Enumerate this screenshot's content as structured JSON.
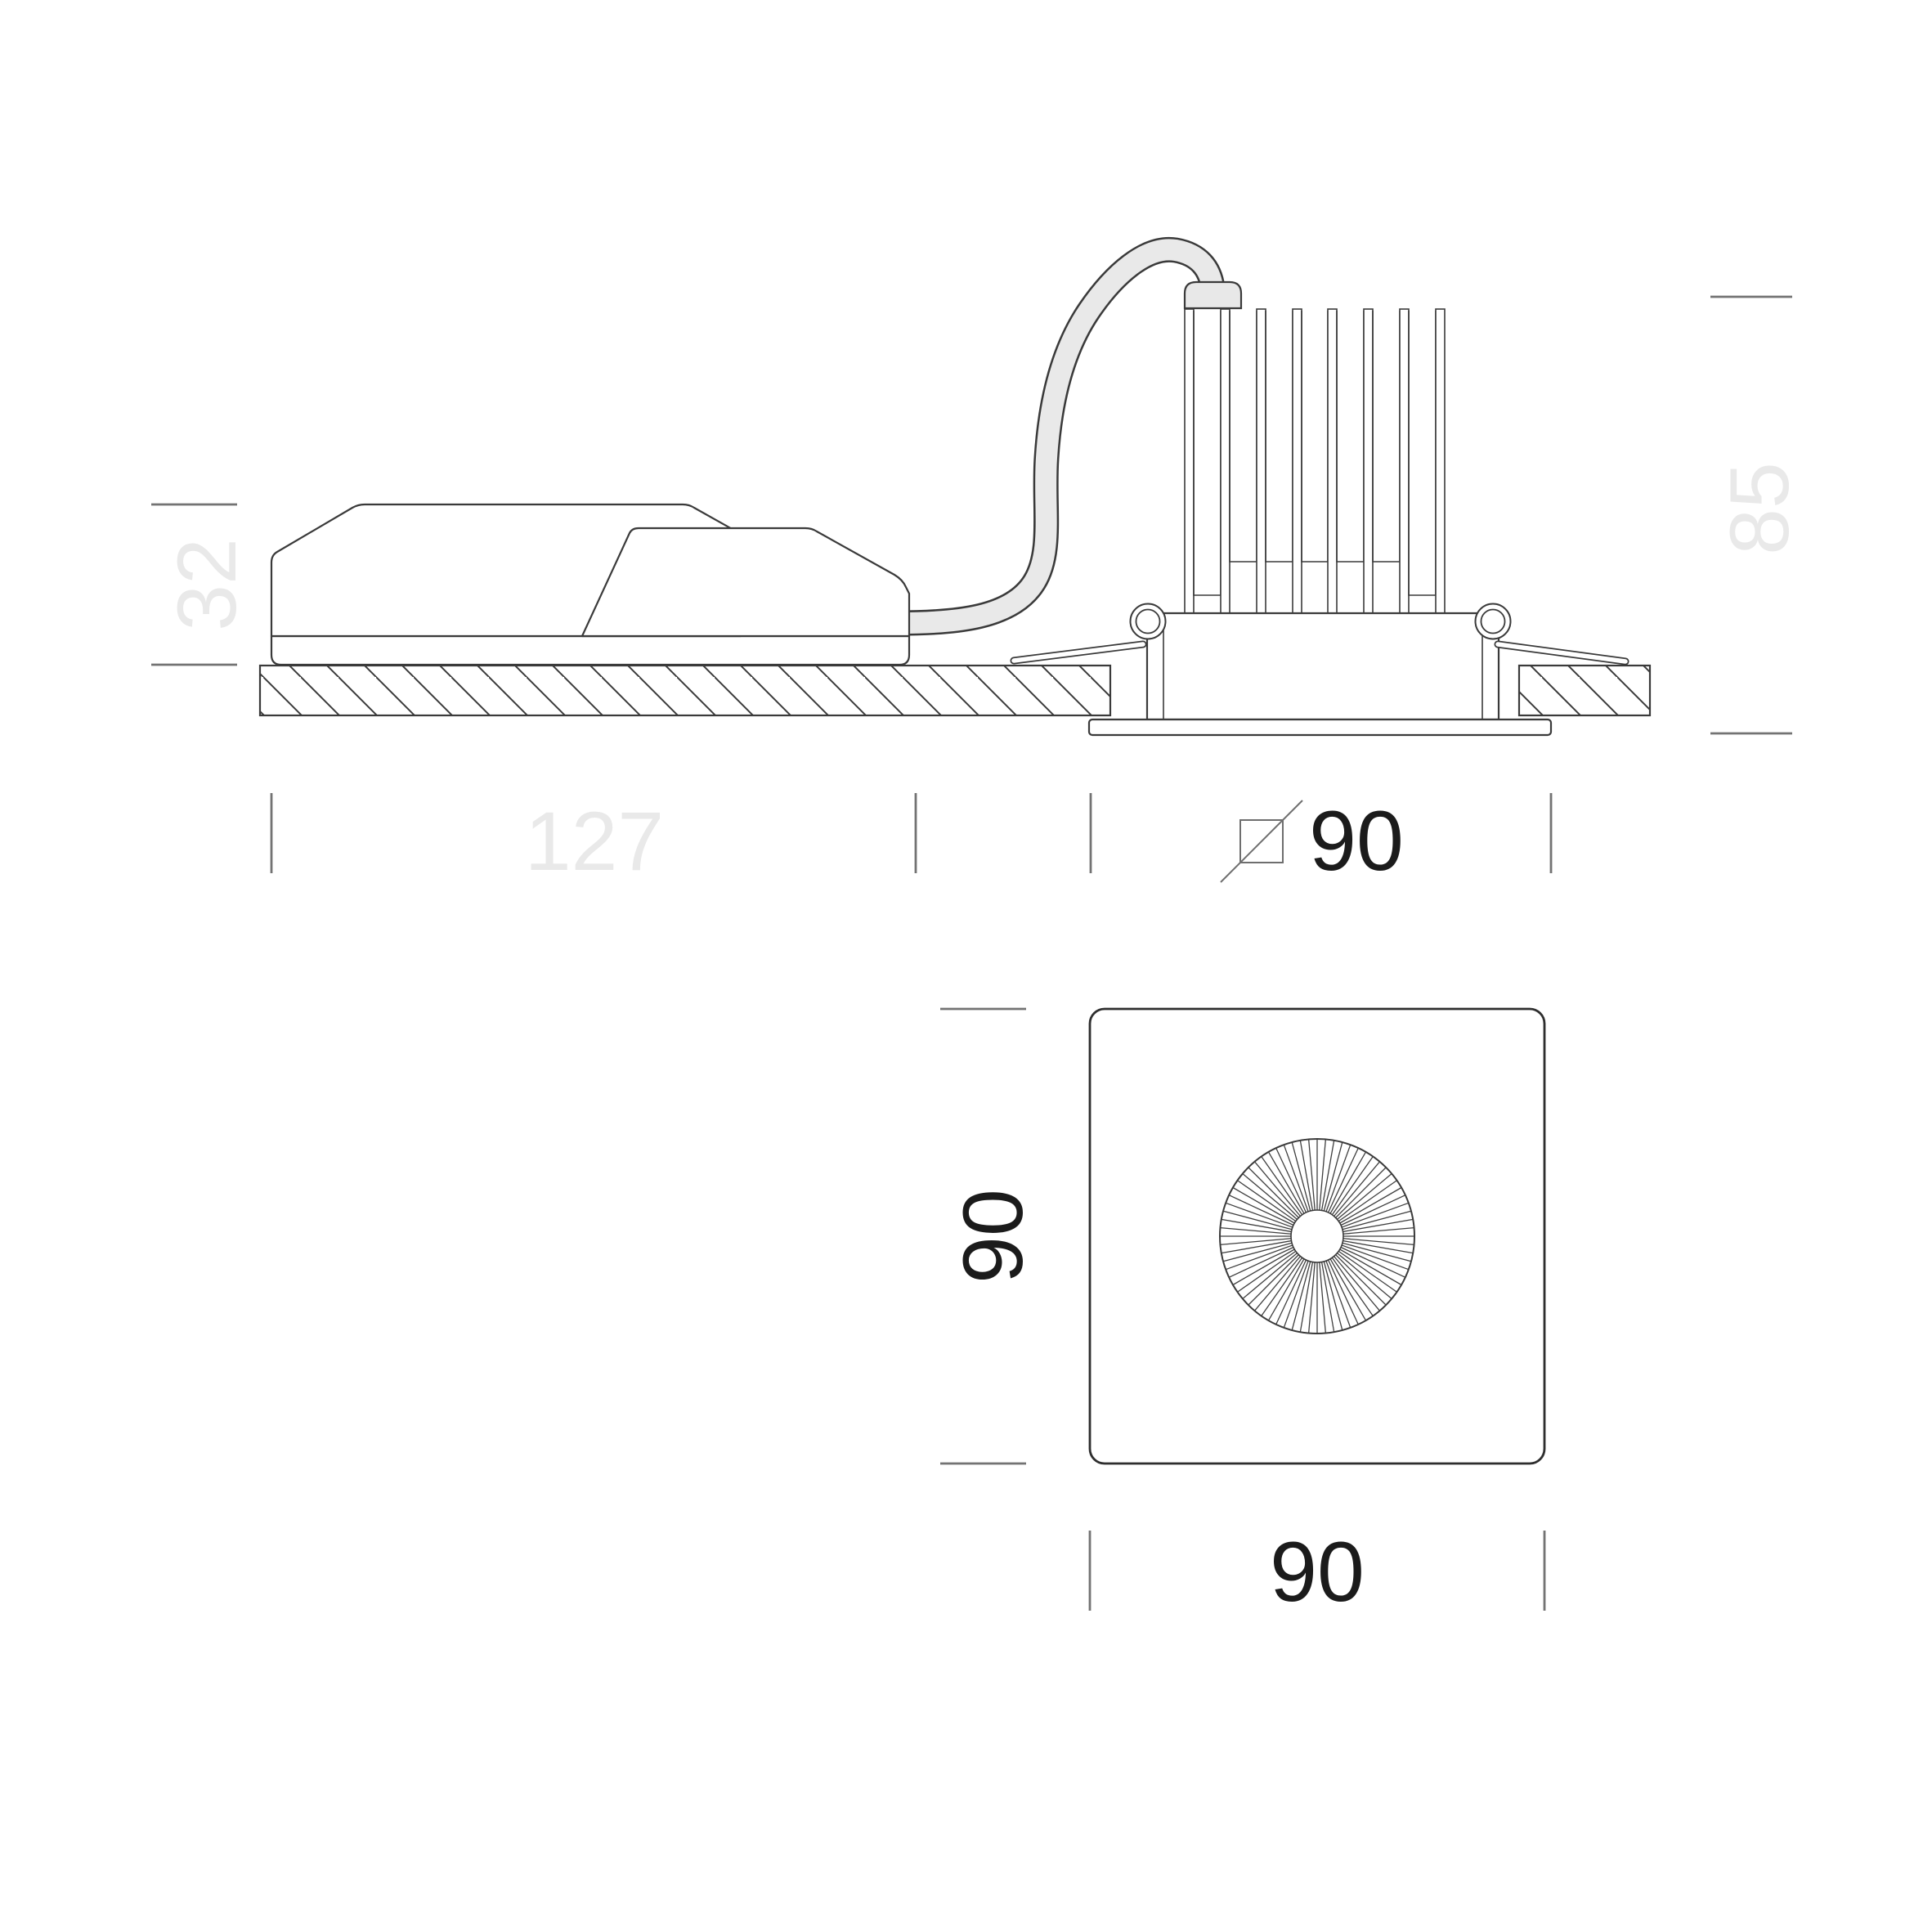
{
  "drawing": {
    "title": "recessed-downlight-dimension-drawing",
    "side_view": {
      "driver_height_mm": "32",
      "driver_length_mm": "127",
      "luminaire_height_mm": "85",
      "ceiling_cutout_mm": "90",
      "cutout_symbol": "square-cutout-icon"
    },
    "front_view": {
      "trim_height_mm": "90",
      "trim_width_mm": "90"
    },
    "colors": {
      "background": "#ffffff",
      "line": "#3a3a3a",
      "light_dimension_text": "#e9e9e9",
      "dark_dimension_text": "#1b1b1b",
      "tick": "#737373",
      "cable_fill": "#e8e8e8"
    }
  }
}
